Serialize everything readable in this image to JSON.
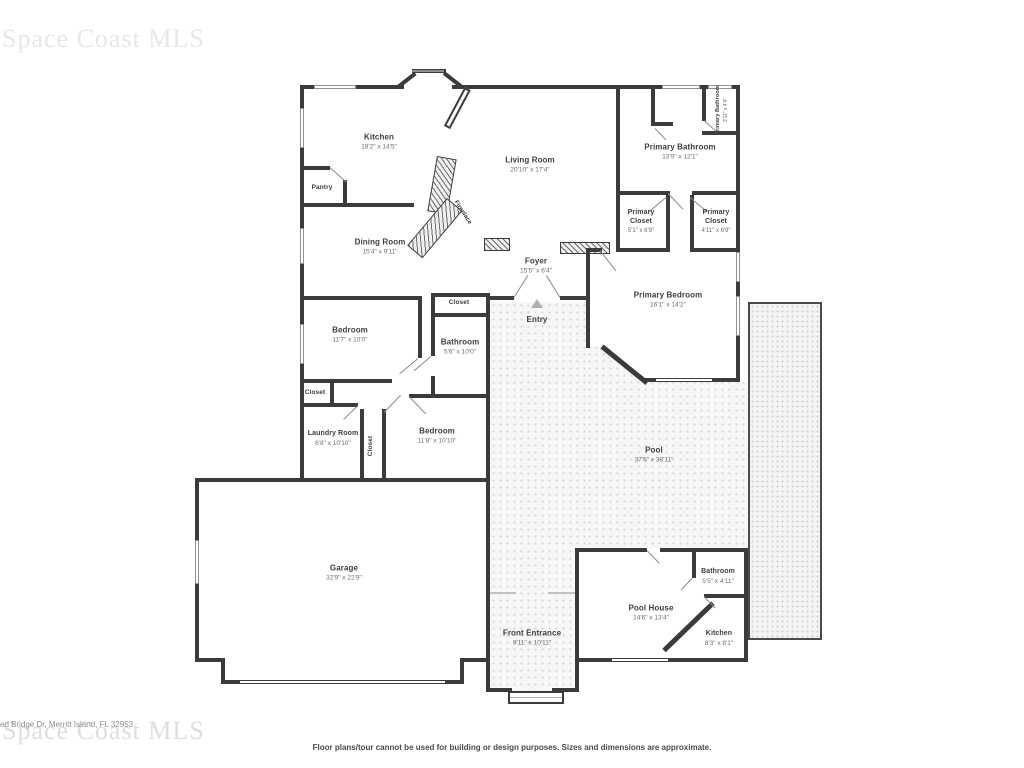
{
  "watermark": {
    "brand": "Space Coast MLS",
    "address": "ed Bridge Dr, Merritt Island, FL 32953"
  },
  "footer": {
    "disclaimer": "Floor plans/tour cannot be used for building or design purposes. Sizes and dimensions are approximate."
  },
  "rooms": {
    "kitchen": {
      "name": "Kitchen",
      "dims": "18'2\" x 14'5\""
    },
    "pantry": {
      "name": "Pantry",
      "dims": ""
    },
    "dining_room": {
      "name": "Dining Room",
      "dims": "15'4\" x 9'11\""
    },
    "living_room": {
      "name": "Living Room",
      "dims": "20'10\" x 17'4\""
    },
    "fireplace": {
      "name": "Fireplace",
      "dims": ""
    },
    "primary_bathroom": {
      "name": "Primary Bathroom",
      "dims": "13'9\" x 12'1\""
    },
    "primary_bathroom_wc": {
      "name": "Primary Bathroom",
      "dims": "3'11\" x 4'4\""
    },
    "primary_closet_left": {
      "name": "Primary Closet",
      "dims": "5'1\" x 6'9\""
    },
    "primary_closet_right": {
      "name": "Primary Closet",
      "dims": "4'11\" x 6'9\""
    },
    "foyer": {
      "name": "Foyer",
      "dims": "15'5\" x 6'4\""
    },
    "primary_bedroom": {
      "name": "Primary Bedroom",
      "dims": "16'1\" x 14'2\""
    },
    "entry": {
      "name": "Entry",
      "dims": ""
    },
    "hall_closet": {
      "name": "Closet",
      "dims": ""
    },
    "bedroom_left": {
      "name": "Bedroom",
      "dims": "11'7\" x 10'0\""
    },
    "hall_bathroom": {
      "name": "Bathroom",
      "dims": "5'6\" x 10'0\""
    },
    "small_closet": {
      "name": "Closet",
      "dims": ""
    },
    "laundry_room": {
      "name": "Laundry Room",
      "dims": "6'8\" x 10'10\""
    },
    "mid_closet": {
      "name": "Closet",
      "dims": ""
    },
    "bedroom_mid": {
      "name": "Bedroom",
      "dims": "11'8\" x 10'10\""
    },
    "garage": {
      "name": "Garage",
      "dims": "32'9\" x 22'9\""
    },
    "pool": {
      "name": "Pool",
      "dims": "37'6\" x 38'11\""
    },
    "front_entrance": {
      "name": "Front Entrance",
      "dims": "9'11\" x 10'11\""
    },
    "pool_house": {
      "name": "Pool House",
      "dims": "14'6\" x 13'4\""
    },
    "pool_house_bathroom": {
      "name": "Bathroom",
      "dims": "5'5\" x 4'11\""
    },
    "pool_house_kitchen": {
      "name": "Kitchen",
      "dims": "8'3\" x 8'1\""
    }
  }
}
